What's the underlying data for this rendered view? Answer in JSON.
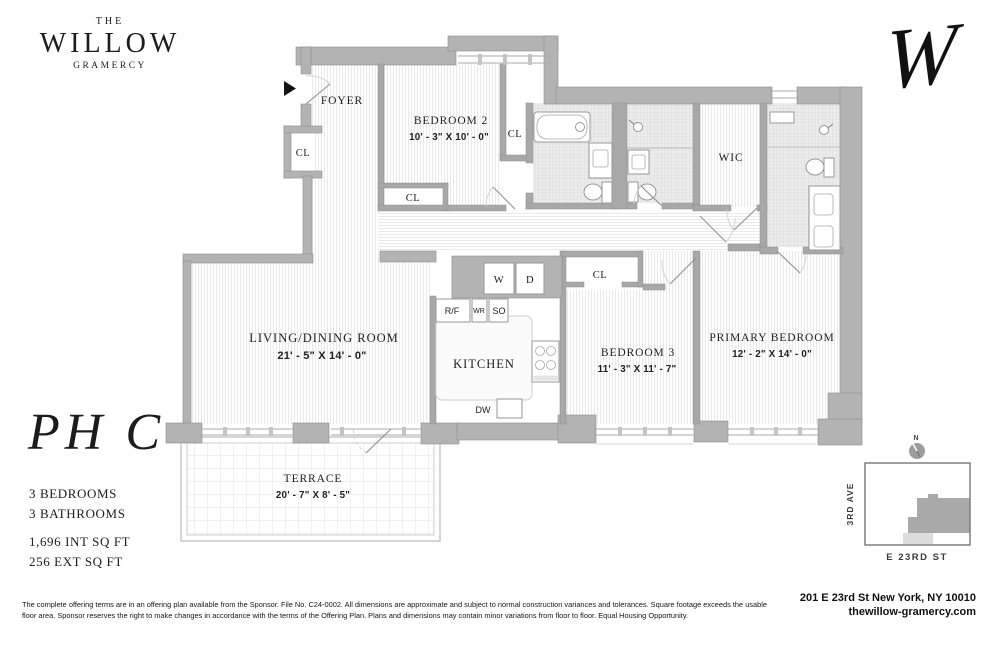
{
  "brand": {
    "the": "THE",
    "name": "WILLOW",
    "sub": "GRAMERCY",
    "monogram": "W"
  },
  "unit": {
    "name": "PH C",
    "bedrooms": "3 BEDROOMS",
    "bathrooms": "3 BATHROOMS",
    "int_sqft": "1,696 INT SQ FT",
    "ext_sqft": "256 EXT SQ FT"
  },
  "rooms": {
    "foyer": {
      "label": "FOYER"
    },
    "bedroom2": {
      "label": "BEDROOM 2",
      "dims": "10' - 3\" X 10' - 0\""
    },
    "bedroom3": {
      "label": "BEDROOM 3",
      "dims": "11' - 3\" X 11' - 7\""
    },
    "primary_bedroom": {
      "label": "PRIMARY BEDROOM",
      "dims": "12' - 2\" X 14' - 0\""
    },
    "living_dining": {
      "label": "LIVING/DINING ROOM",
      "dims": "21' - 5\" X 14' - 0\""
    },
    "kitchen": {
      "label": "KITCHEN"
    },
    "terrace": {
      "label": "TERRACE",
      "dims": "20' - 7\" X 8' - 5\""
    },
    "wic": {
      "label": "WIC"
    },
    "closet": {
      "label": "CL"
    }
  },
  "appliances": {
    "washer": "W",
    "dryer": "D",
    "fridge": "R/F",
    "wine_fridge": "WR",
    "speed_oven": "SO",
    "dishwasher": "DW"
  },
  "map": {
    "north": "N",
    "avenue": "3RD AVE",
    "street": "E 23RD ST"
  },
  "footer": {
    "address": "201 E 23rd St New York, NY 10010",
    "website": "thewillow-gramercy.com",
    "disclaimer": "The complete offering terms are in an offering plan available from the Sponsor. File No. C24-0002.   All dimensions are approximate and subject to normal construction variances and tolerances. Square footage exceeds the usable floor area. Sponsor reserves the right to make changes in accordance with the terms of the Offering Plan. Plans and dimensions may contain minor variations from floor to floor.  Equal Housing Opportunity."
  },
  "colors": {
    "wall": "#b3b3b3",
    "wall_interior": "#a8a8a8",
    "tile": "#ececec",
    "footprint": "#a9a9a9"
  }
}
